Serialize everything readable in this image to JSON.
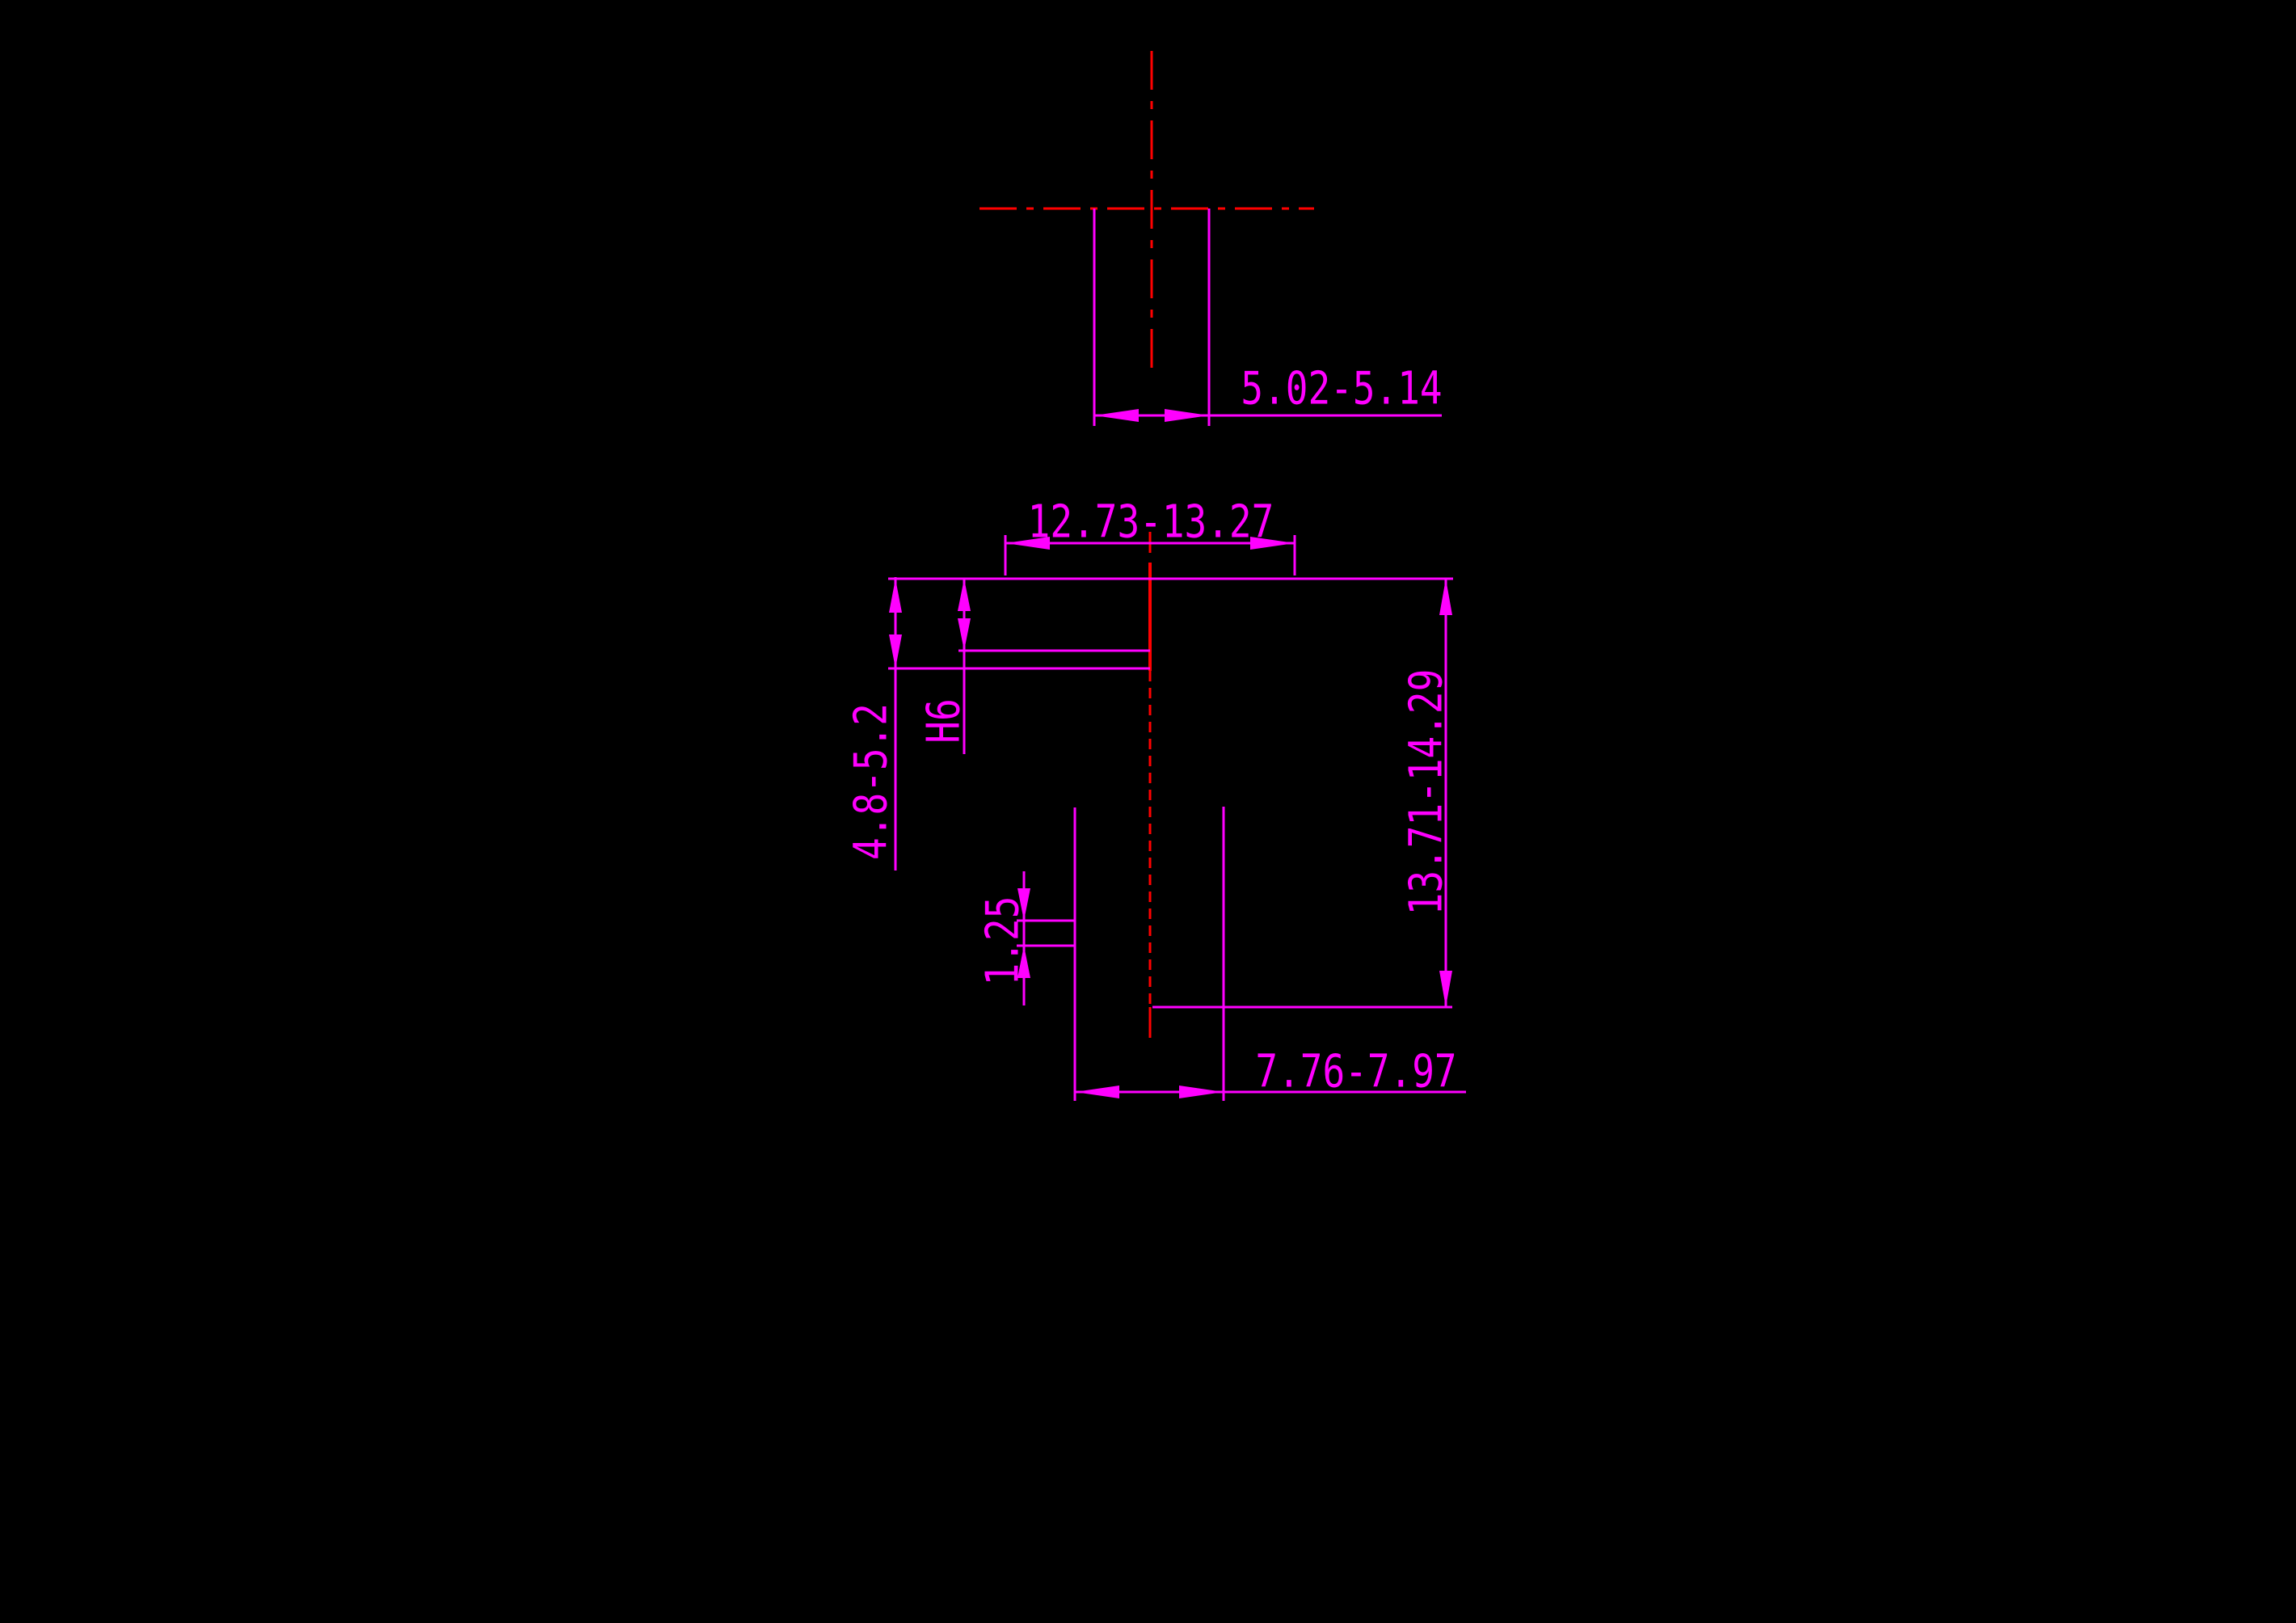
{
  "drawing": {
    "background_color": "#000000",
    "geometry_color": "#ff00ff",
    "centerline_color": "#ff0000",
    "top_view": {
      "pin_width_dim": "5.02-5.14"
    },
    "front_view": {
      "head_width_dim": "12.73-13.27",
      "head_height_dim": "4.8-5.2",
      "bore_fit_label": "H6",
      "groove_width_dim": "1.25",
      "overall_height_dim": "13.71-14.29",
      "shaft_width_dim": "7.76-7.97"
    }
  }
}
